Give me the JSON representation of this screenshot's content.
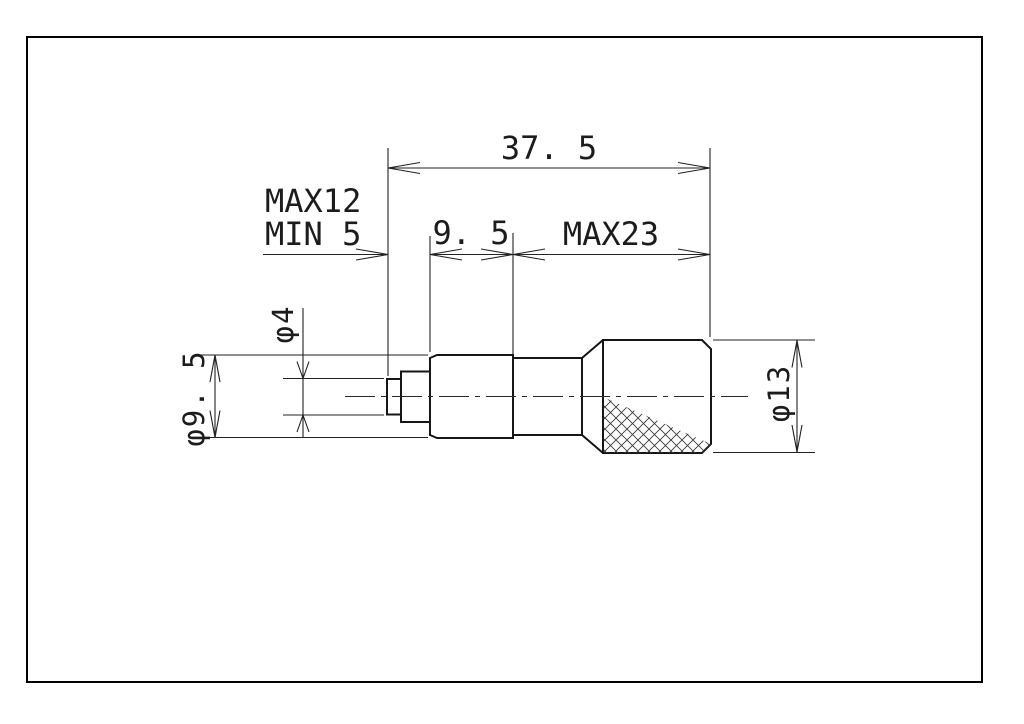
{
  "drawing": {
    "type": "engineering-dimension-drawing",
    "background_color": "#ffffff",
    "frame_color": "#000000",
    "line_color": "#1c1c1c",
    "labels": {
      "overall_length": "37. 5",
      "spindle_travel_max": "MAX12",
      "spindle_travel_min": "MIN 5",
      "body_length": "9. 5",
      "thimble_length": "MAX23",
      "tip_diameter": "φ4",
      "body_diameter": "φ9. 5",
      "thimble_diameter": "φ13"
    }
  }
}
